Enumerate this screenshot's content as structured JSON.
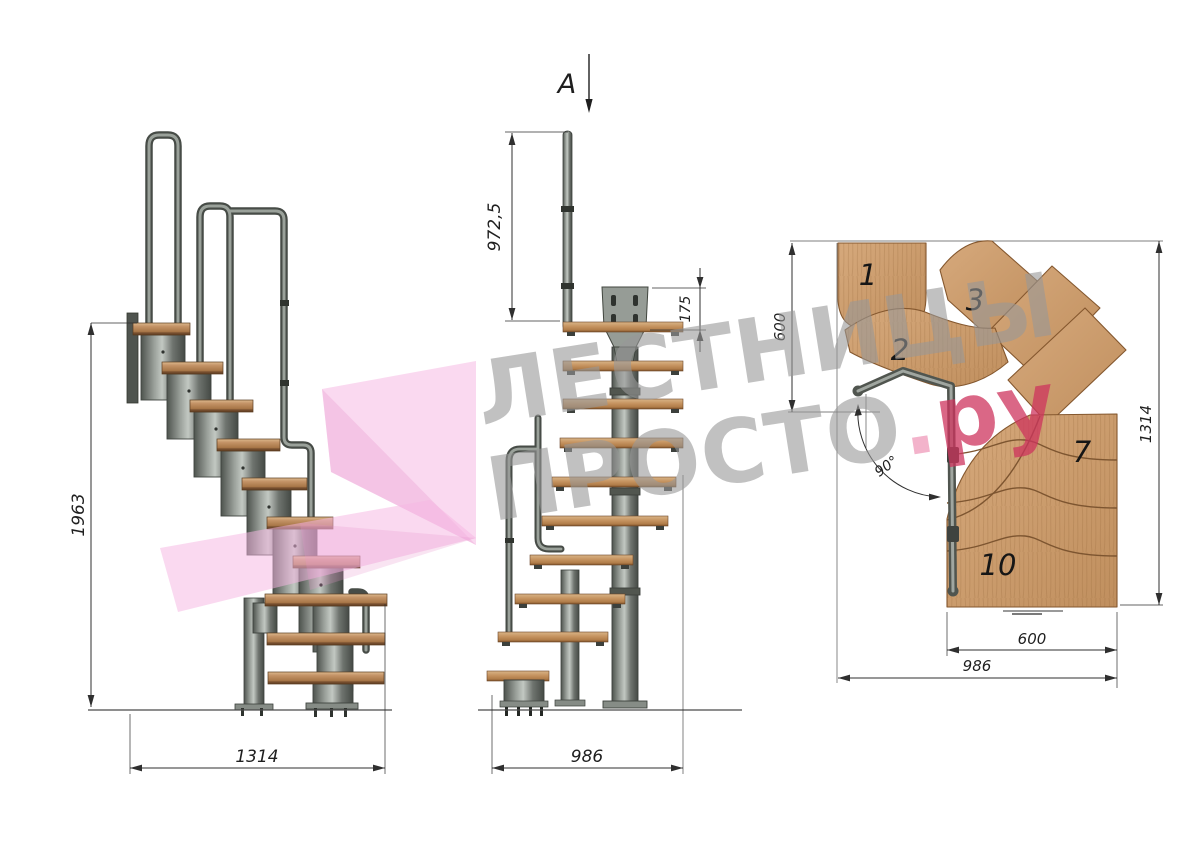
{
  "watermark": {
    "line1": "ЛЕСТНИЦЫ",
    "line2": "ПРОСТО",
    "dot": ".",
    "suffix": "ру"
  },
  "side_view": {
    "dim_height": "1963",
    "dim_length": "1314"
  },
  "front_view": {
    "section_label": "A",
    "dim_rail_height": "972,5",
    "dim_plate_height": "175",
    "dim_width": "986"
  },
  "plan_view": {
    "dim_left_width": "600",
    "dim_height": "1314",
    "dim_tread_width": "600",
    "dim_total_width": "986",
    "dim_angle": "90°",
    "steps": {
      "n1": "1",
      "n2": "2",
      "n3": "3",
      "n7": "7",
      "n10": "10"
    }
  },
  "colors": {
    "wood": "#cda06f",
    "wood_edge": "#84572e",
    "steel": "#7a807a",
    "steel_dark": "#474c47",
    "dimension_line": "#2f2f2f",
    "watermark_gray": "#989898",
    "watermark_pink": "#cd345e",
    "ribbon_pink": "#f6b7e2"
  }
}
